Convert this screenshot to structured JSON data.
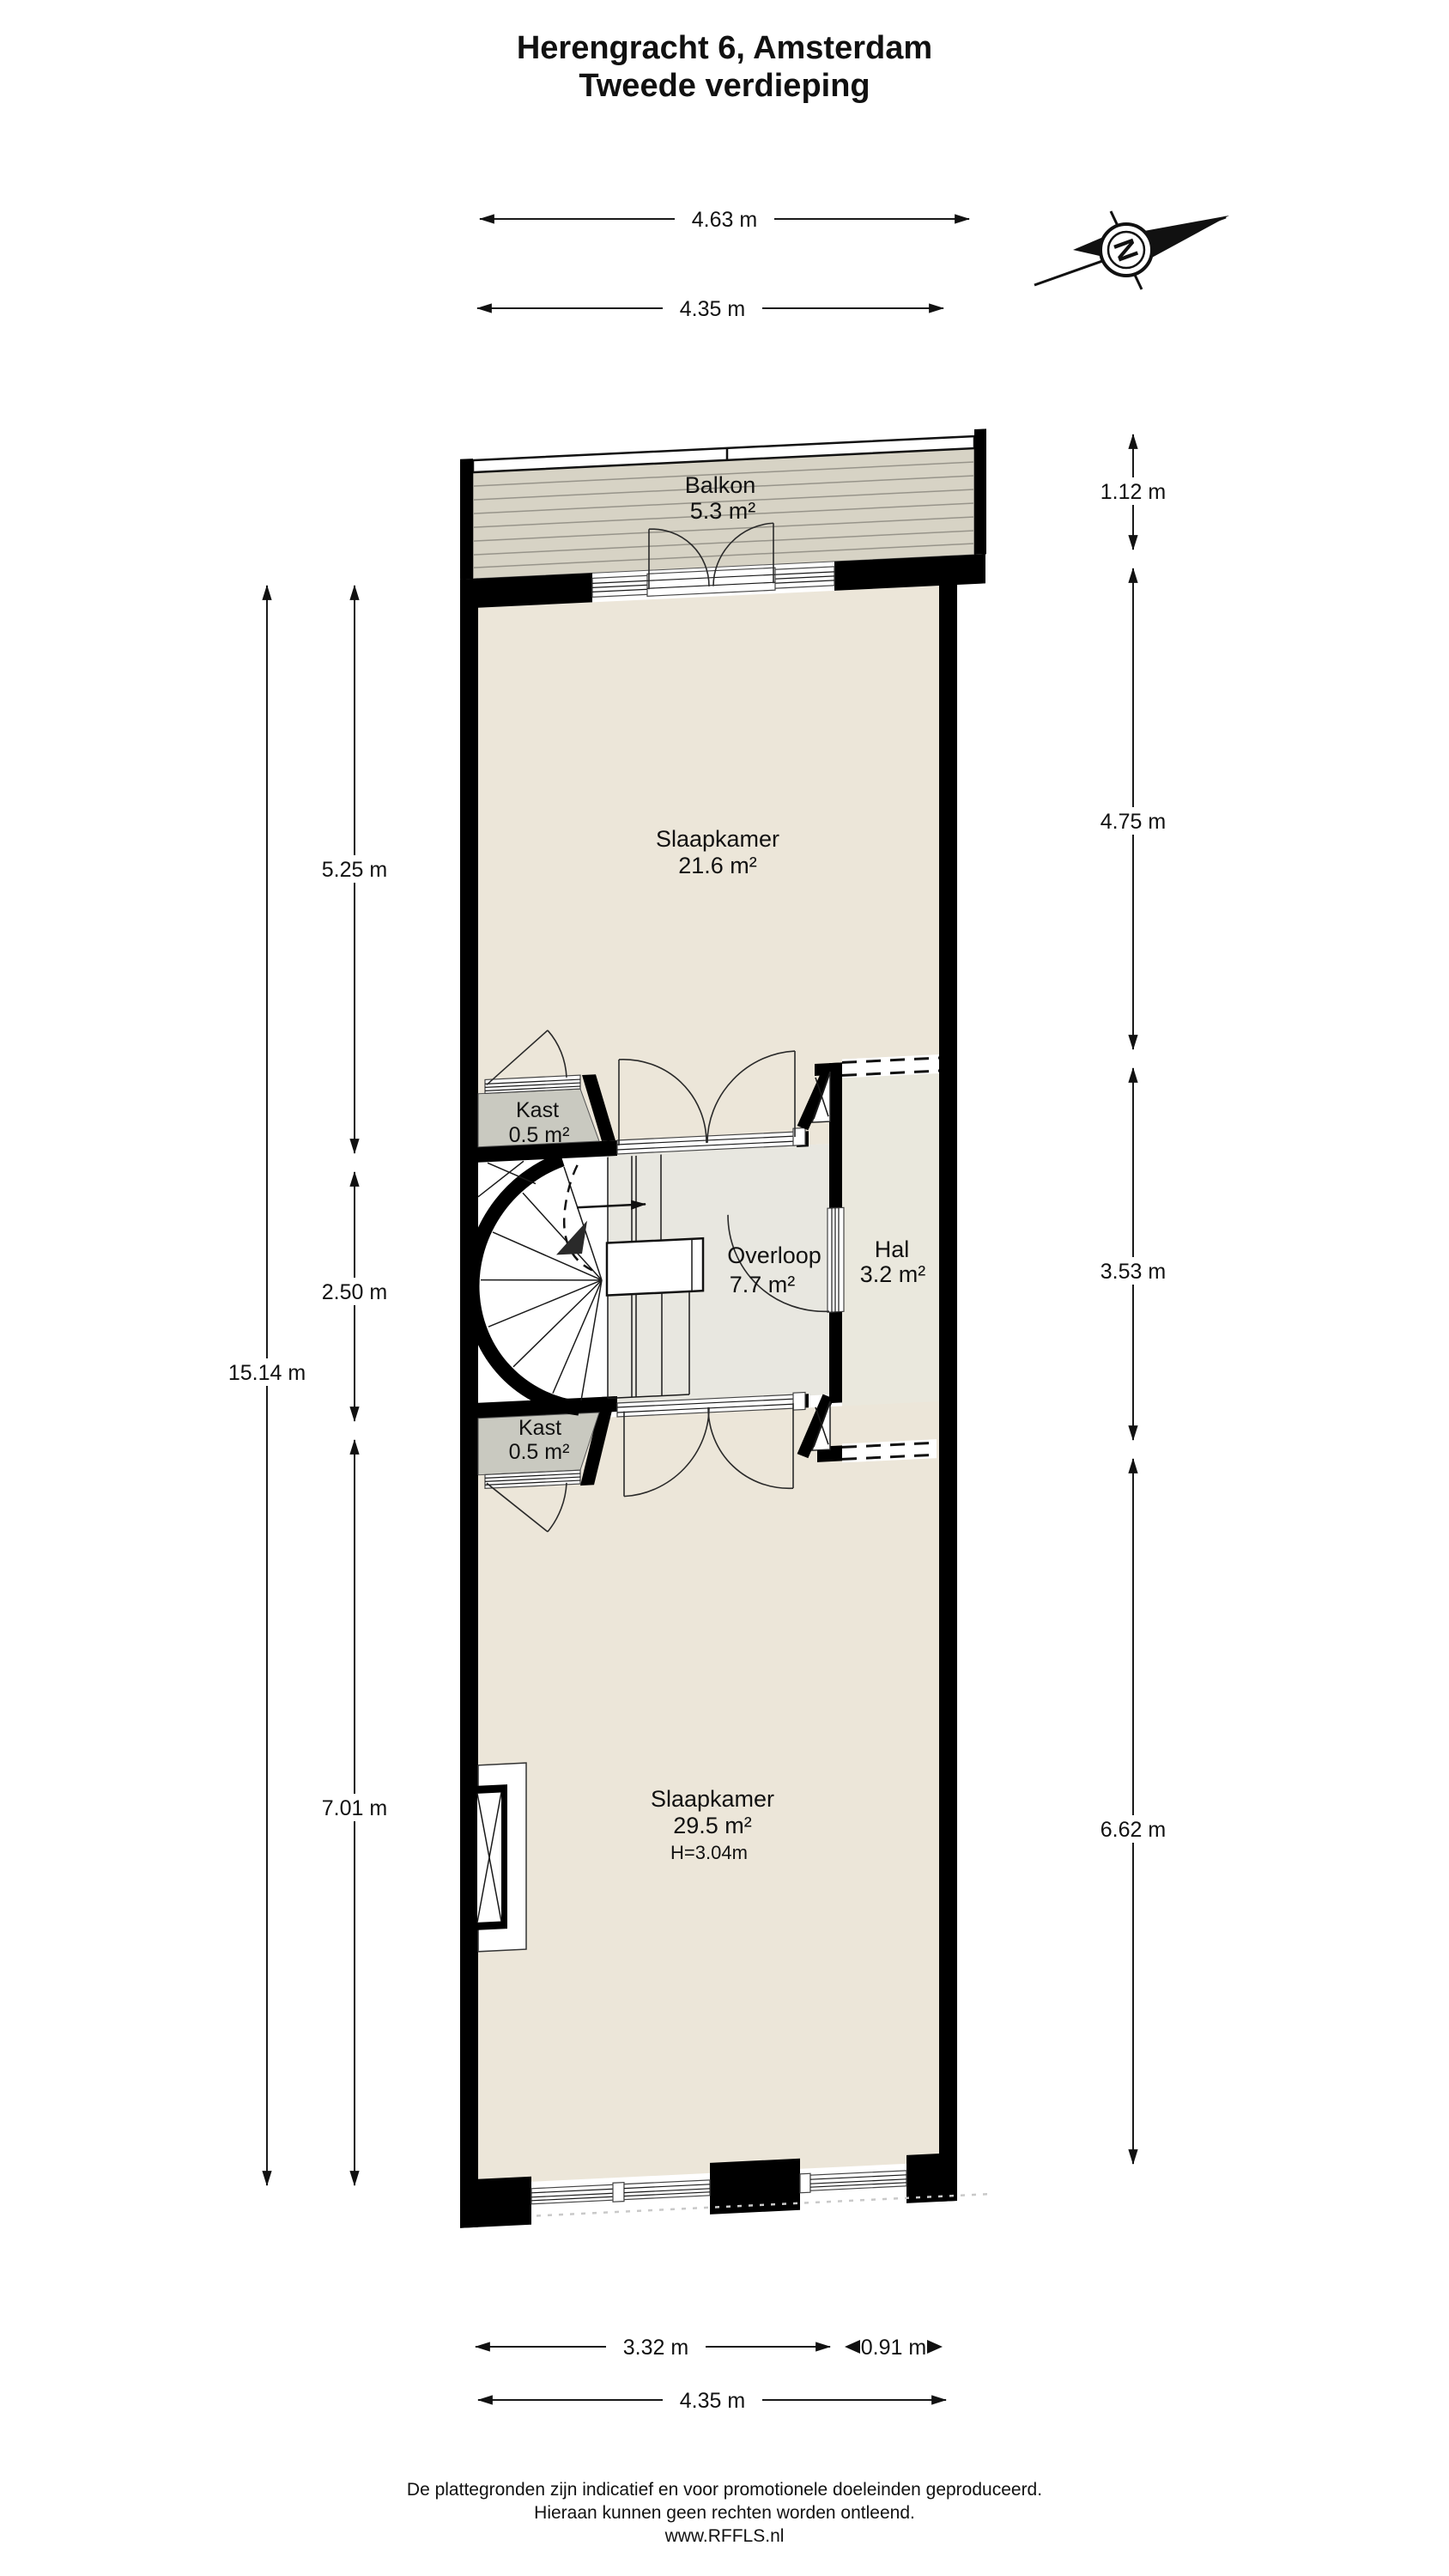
{
  "title": {
    "line1": "Herengracht 6, Amsterdam",
    "line2": "Tweede verdieping"
  },
  "compass": {
    "label": "N"
  },
  "rooms": {
    "balkon": {
      "name": "Balkon",
      "area": "5.3 m²"
    },
    "slaapkamer1": {
      "name": "Slaapkamer",
      "area": "21.6 m²"
    },
    "kast1": {
      "name": "Kast",
      "area": "0.5 m²"
    },
    "overloop": {
      "name": "Overloop",
      "area": "7.7 m²"
    },
    "hal": {
      "name": "Hal",
      "area": "3.2 m²"
    },
    "kast2": {
      "name": "Kast",
      "area": "0.5 m²"
    },
    "slaapkamer2": {
      "name": "Slaapkamer",
      "area": "29.5 m²",
      "height": "H=3.04m"
    }
  },
  "dimensions": {
    "top": [
      {
        "label": "4.63 m"
      },
      {
        "label": "4.35 m"
      }
    ],
    "right": [
      {
        "label": "1.12 m"
      },
      {
        "label": "4.75 m"
      },
      {
        "label": "3.53 m"
      },
      {
        "label": "6.62 m"
      }
    ],
    "left": [
      {
        "label": "15.14 m"
      },
      {
        "label": "5.25 m"
      },
      {
        "label": "2.50 m"
      },
      {
        "label": "7.01 m"
      }
    ],
    "bottom": [
      {
        "label": "3.32 m"
      },
      {
        "label": "0.91 m"
      },
      {
        "label": "4.35 m"
      }
    ]
  },
  "footer": {
    "line1": "De plattegronden zijn indicatief en voor promotionele doeleinden geproduceerd.",
    "line2": "Hieraan kunnen geen rechten worden ontleend.",
    "line3": "www.RFFLS.nl"
  },
  "colors": {
    "wall": "#000000",
    "floor": "#ece6d9",
    "balcony_deck": "#d7d3c5",
    "closet": "#c9c9c0",
    "hall": "#eae8dd",
    "landing_zone": "#e8e7e0"
  }
}
